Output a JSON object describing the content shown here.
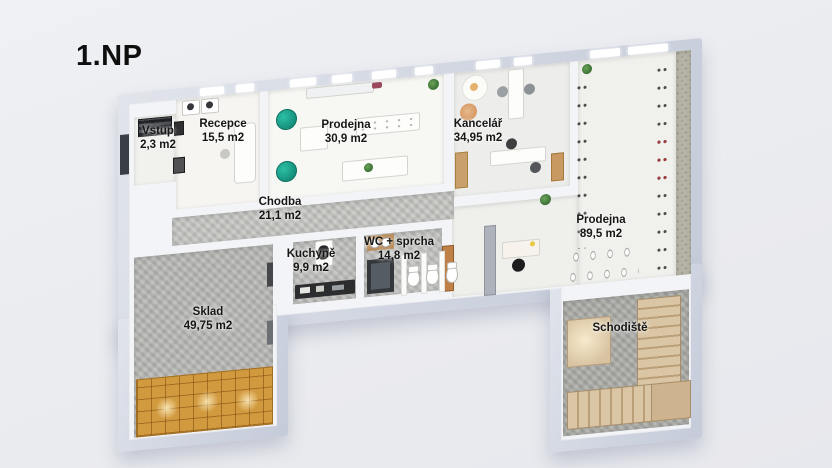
{
  "title": "1.NP",
  "rooms": [
    {
      "name": "Vstup",
      "area": "2,3 m2"
    },
    {
      "name": "Recepce",
      "area": "15,5 m2"
    },
    {
      "name": "Prodejna",
      "area": "30,9 m2"
    },
    {
      "name": "Kancelář",
      "area": "34,95 m2"
    },
    {
      "name": "Chodba",
      "area": "21,1 m2"
    },
    {
      "name": "Kuchyně",
      "area": "9,9 m2"
    },
    {
      "name": "WC + sprcha",
      "area": "14,8 m2"
    },
    {
      "name": "Prodejna",
      "area": "89,5 m2"
    },
    {
      "name": "Sklad",
      "area": "49,75 m2"
    },
    {
      "name": "Schodiště",
      "area": ""
    }
  ],
  "colors": {
    "background": "#ecedf1",
    "outer_wall": "#d0d5e1",
    "inner_wall": "#f3f4f7",
    "floor_light": "#f6f5f2",
    "floor_concrete": "#bdbdbb",
    "wallpaper": "#b5b4a6",
    "wood_door": "#c08148",
    "pallet_wood": "#d29a3f",
    "stairs_wood": "#dac6a5",
    "teal_chair": "#128a77",
    "label_text": "#161616"
  }
}
